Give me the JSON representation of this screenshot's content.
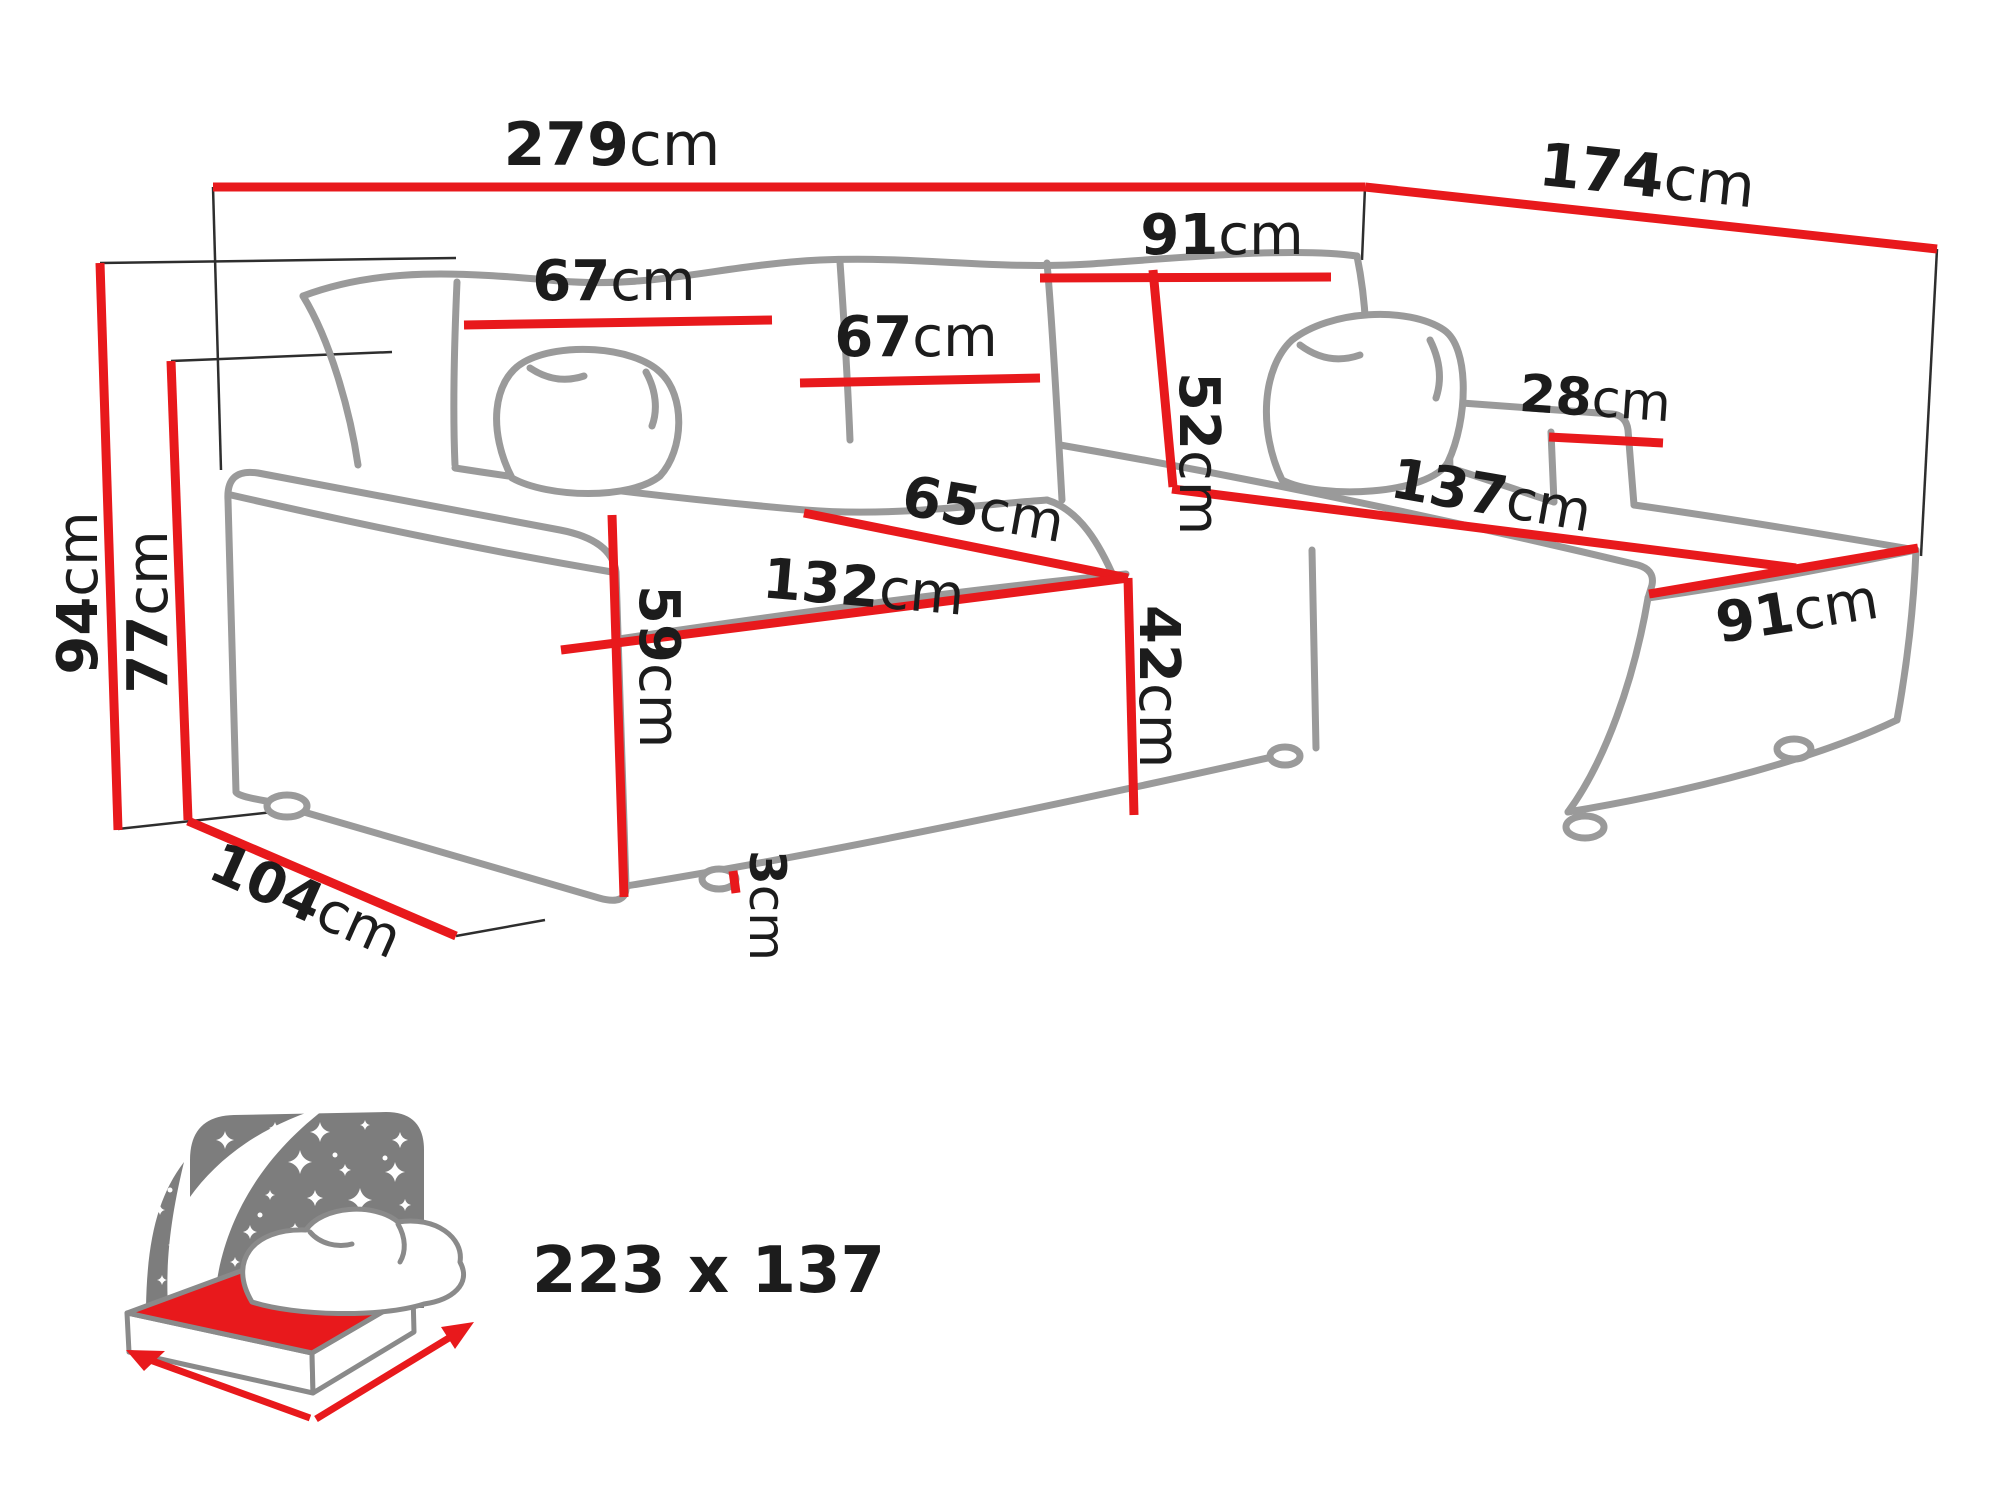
{
  "diagram": {
    "type": "furniture-dimension-diagram",
    "subject": "corner sofa bed with chaise",
    "colors": {
      "dimension_red": "#e8191c",
      "sketch_gray": "#9a9a9a",
      "guide_black": "#2e2e2e",
      "label_black": "#1c1c1c",
      "icon_gray": "#7d7d7d",
      "icon_text_gray": "#6e6e6e",
      "background": "#ffffff"
    },
    "dimensions": {
      "total_width": {
        "value": "279",
        "unit": "cm"
      },
      "total_depth": {
        "value": "174",
        "unit": "cm"
      },
      "total_height": {
        "value": "94",
        "unit": "cm"
      },
      "armrest_height": {
        "value": "77",
        "unit": "cm"
      },
      "back_cushion_left_width": {
        "value": "67",
        "unit": "cm"
      },
      "back_cushion_mid_width": {
        "value": "67",
        "unit": "cm"
      },
      "corner_backrest_width": {
        "value": "91",
        "unit": "cm"
      },
      "backrest_height": {
        "value": "52",
        "unit": "cm"
      },
      "seat_depth": {
        "value": "65",
        "unit": "cm"
      },
      "seat_width": {
        "value": "132",
        "unit": "cm"
      },
      "arm_front_height": {
        "value": "59",
        "unit": "cm"
      },
      "seat_height": {
        "value": "42",
        "unit": "cm"
      },
      "leg_height": {
        "value": "3",
        "unit": "cm"
      },
      "base_depth": {
        "value": "104",
        "unit": "cm"
      },
      "right_arm_width": {
        "value": "28",
        "unit": "cm"
      },
      "chaise_length": {
        "value": "137",
        "unit": "cm"
      },
      "chaise_width": {
        "value": "91",
        "unit": "cm"
      }
    },
    "sleeping_area": {
      "label": "223 x 137"
    }
  }
}
